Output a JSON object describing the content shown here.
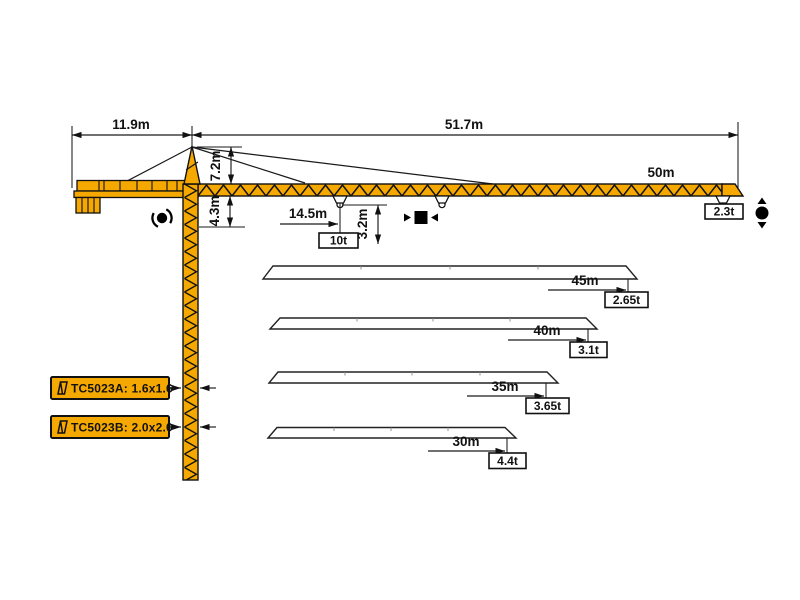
{
  "crane": {
    "colors": {
      "body": "#F5A800",
      "outline": "#111111",
      "background": "#FFFFFF"
    },
    "overall_dims": {
      "counter_jib_length": "11.9m",
      "jib_working_length": "51.7m",
      "cat_head_height": "7.2m",
      "jib_to_slewing_height": "4.3m"
    },
    "max_load_point": {
      "radius": "14.5m",
      "load": "10t",
      "hook_clearance": "3.2m"
    },
    "main_jib": {
      "length": "50m",
      "tip_load": "2.3t"
    },
    "jib_configs": [
      {
        "length": "45m",
        "tip_load": "2.65t"
      },
      {
        "length": "40m",
        "tip_load": "3.1t"
      },
      {
        "length": "35m",
        "tip_load": "3.65t"
      },
      {
        "length": "30m",
        "tip_load": "4.4t"
      }
    ],
    "mast_options": [
      {
        "label": "TC5023A: 1.6x1.6"
      },
      {
        "label": "TC5023B: 2.0x2.0"
      }
    ],
    "icons": {
      "slewing": "slewing-rotation-icon",
      "trolley": "trolley-travel-icon",
      "hoist": "hook-hoist-icon",
      "mast_section": "mast-section-icon"
    }
  }
}
